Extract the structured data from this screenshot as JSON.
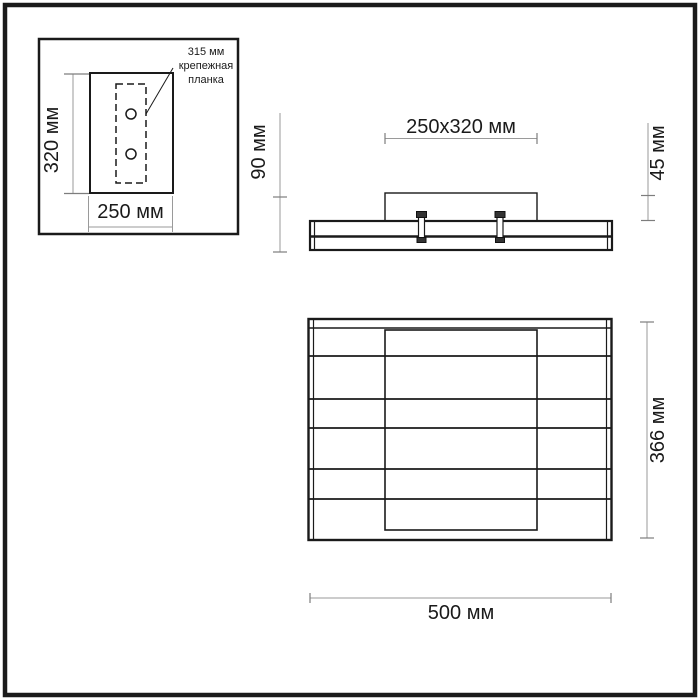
{
  "diagram": {
    "colors": {
      "background": "#ffffff",
      "ink": "#1a1a1a",
      "dim": "#9a9a9a",
      "tick": "#7d7d7d"
    },
    "inset": {
      "height_label": "320 мм",
      "width_label": "250 мм",
      "annotation": {
        "line1": "315 мм",
        "line2": "крепежная",
        "line3": "планка"
      }
    },
    "side_view": {
      "mount_size_label": "250x320 мм",
      "total_height_label": "90 мм",
      "bracket_height_label": "45 мм"
    },
    "front_view": {
      "height_label": "366 мм",
      "width_label": "500 мм"
    }
  }
}
